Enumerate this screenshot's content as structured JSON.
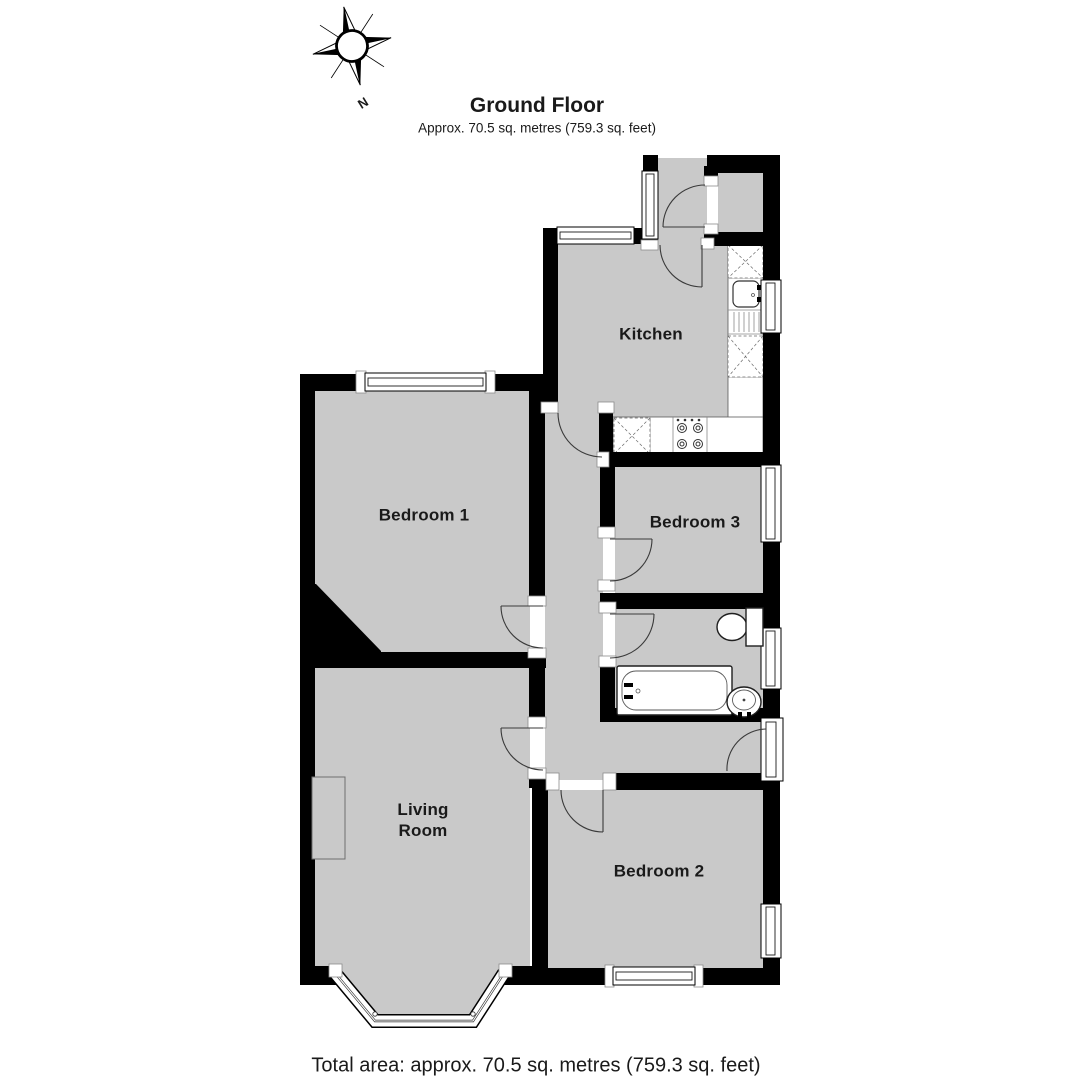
{
  "header": {
    "title": "Ground Floor",
    "subtitle": "Approx. 70.5 sq. metres (759.3 sq. feet)"
  },
  "compass": {
    "north_label": "N"
  },
  "rooms": [
    {
      "id": "kitchen",
      "label": "Kitchen"
    },
    {
      "id": "bedroom-1",
      "label": "Bedroom 1"
    },
    {
      "id": "bedroom-3",
      "label": "Bedroom 3"
    },
    {
      "id": "living-room",
      "label": "Living\nRoom"
    },
    {
      "id": "bedroom-2",
      "label": "Bedroom 2"
    }
  ],
  "fixtures": [
    "kitchen-sink",
    "drainer",
    "hob",
    "worktop-units",
    "bathtub",
    "toilet",
    "wash-basin",
    "fireplace",
    "bay-window"
  ],
  "footer": {
    "total_area": "Total area: approx. 70.5 sq. metres (759.3 sq. feet)"
  },
  "colors": {
    "floor": "#c9c9c9",
    "wall": "#000000",
    "outline": "#3a3a3a",
    "text": "#1a1a1a",
    "background": "#ffffff"
  }
}
